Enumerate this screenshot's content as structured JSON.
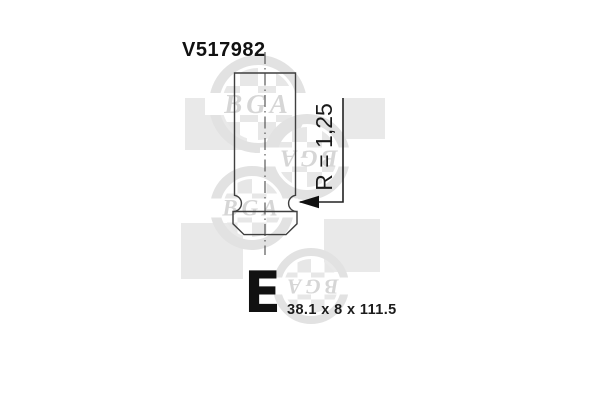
{
  "part_number": "V517982",
  "annotations": {
    "radius": "R = 1,25",
    "class_letter": "E",
    "dimensions": "38.1 x 8 x 111.5"
  },
  "watermark": {
    "brand": "BGA"
  },
  "colors": {
    "line": "#3f3f3f",
    "centerline": "#4a4a4a",
    "leader": "#222222",
    "arrow": "#111111",
    "text": "#111111",
    "wm-square": "#e9e9e9",
    "wm-ring": "#e2e2e2",
    "wm-checker": "#e7e7e7",
    "wm-letters": "#d6d6d6"
  }
}
